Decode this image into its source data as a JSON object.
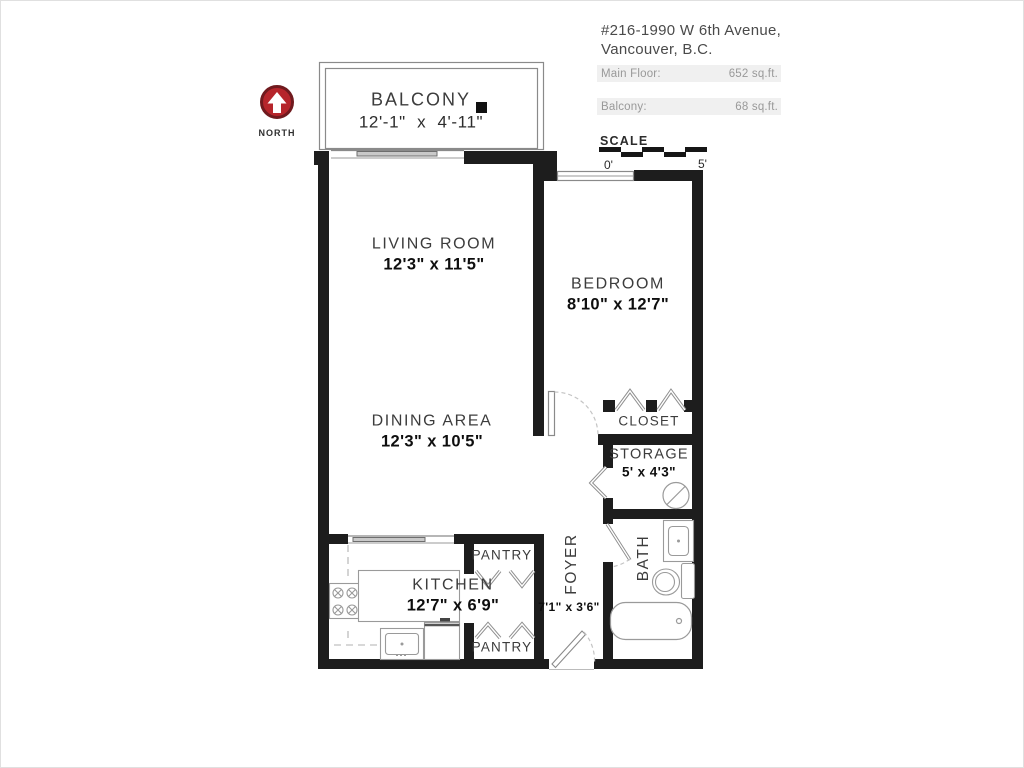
{
  "header": {
    "address_line1": "#216-1990 W 6th Avenue,",
    "address_line2": "Vancouver, B.C.",
    "areas": [
      {
        "label": "Main Floor:",
        "value": "652 sq.ft."
      },
      {
        "label": "Balcony:",
        "value": "68 sq.ft."
      }
    ]
  },
  "compass": {
    "label": "NORTH"
  },
  "scale_bar": {
    "label": "SCALE",
    "start_tick": "0'",
    "end_tick": "5'",
    "segments": 5
  },
  "rooms": {
    "balcony": {
      "name": "BALCONY",
      "dims": "12'-1\" x 4'-11\""
    },
    "living": {
      "name": "LIVING ROOM",
      "dims": "12'3\" x 11'5\""
    },
    "dining": {
      "name": "DINING AREA",
      "dims": "12'3\" x 10'5\""
    },
    "bedroom": {
      "name": "BEDROOM",
      "dims": "8'10\" x 12'7\""
    },
    "closet": {
      "name": "CLOSET"
    },
    "storage": {
      "name": "STORAGE",
      "dims": "5' x 4'3\""
    },
    "kitchen": {
      "name": "KITCHEN",
      "dims": "12'7\" x 6'9\""
    },
    "pantry_top": {
      "name": "PANTRY"
    },
    "pantry_bottom": {
      "name": "PANTRY"
    },
    "foyer": {
      "name": "FOYER",
      "dims": "7'1\" x 3'6\""
    },
    "bath": {
      "name": "BATH"
    }
  },
  "colors": {
    "wall": "#1d1d1d",
    "fixture_line": "#9a9a9a",
    "label_text": "#3c3c3c",
    "dims_text": "#0e0e0e",
    "area_bar_bg": "#f0f0f0",
    "area_bar_text": "#999999",
    "compass_red": "#b6252b"
  }
}
